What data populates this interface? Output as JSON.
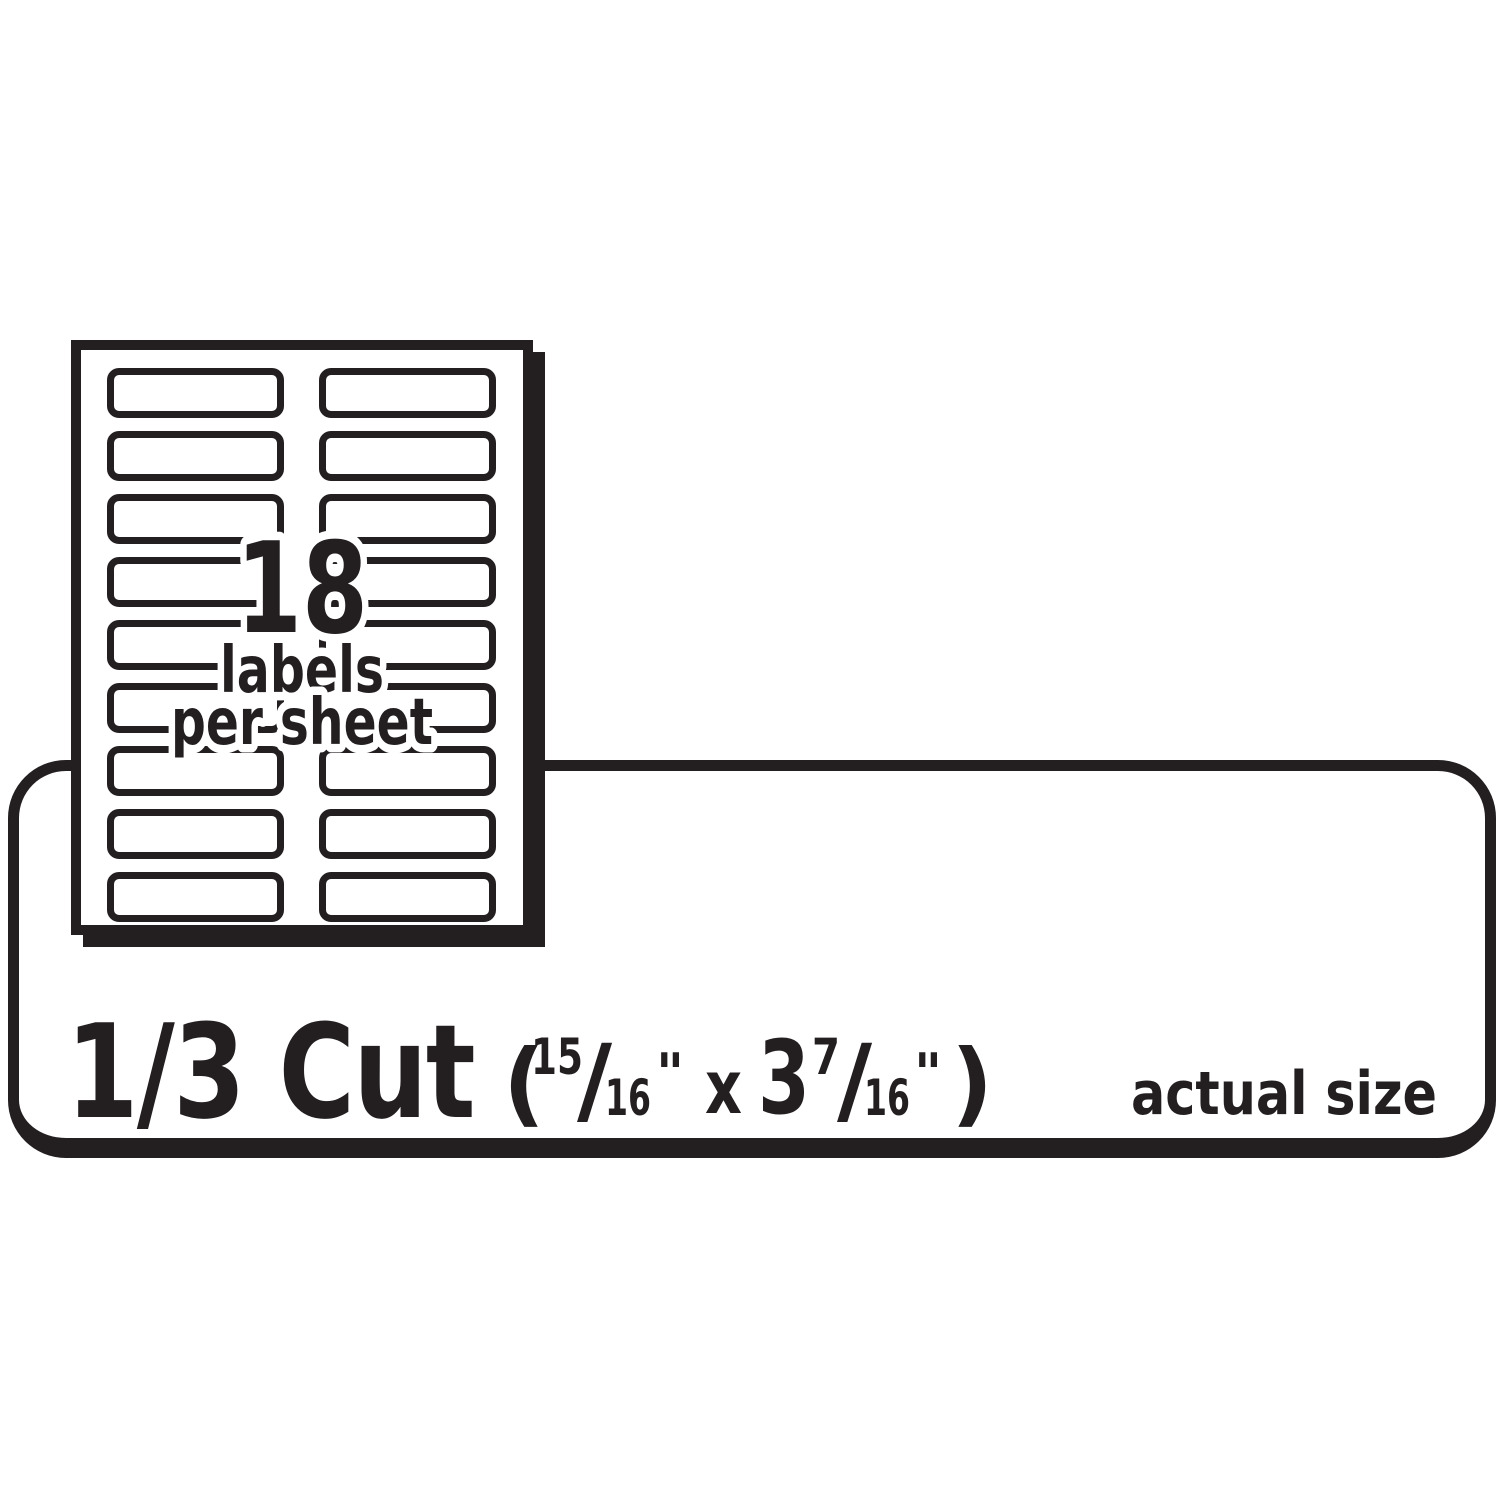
{
  "ink_color": "#231f20",
  "background_color": "#ffffff",
  "sheet": {
    "labels_count": "18",
    "caption_line1": "labels",
    "caption_line2": "per sheet",
    "rows": 9,
    "columns": 2
  },
  "panel": {
    "cut_label": "1/3 Cut",
    "dimensions": {
      "open_paren": "(",
      "width_numerator": "15",
      "width_slash": "/",
      "width_denominator": "16",
      "width_inch_mark": "\"",
      "separator": "x",
      "length_whole": "3",
      "length_numerator": "7",
      "length_slash": "/",
      "length_denominator": "16",
      "length_inch_mark": "\"",
      "close_paren": ")"
    },
    "actual_size_label": "actual size"
  }
}
